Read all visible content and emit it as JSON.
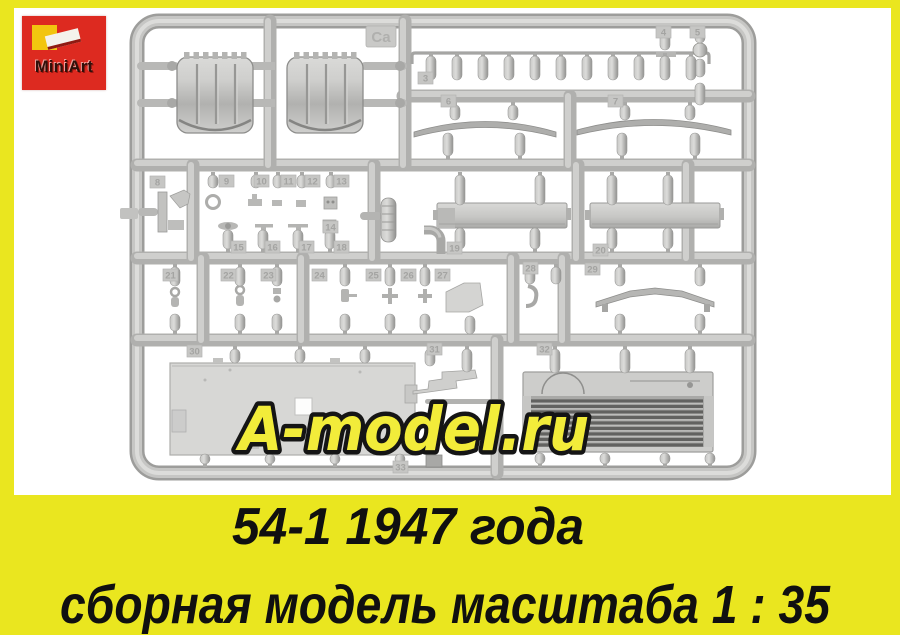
{
  "page": {
    "background_color": "#eae61f",
    "photo_background": "#ffffff"
  },
  "logo": {
    "brand": "MiniArt",
    "background_color": "#dd2a20",
    "square_color": "#f2c50f",
    "text_color": "#30100a"
  },
  "sprue": {
    "plastic_color": "#c6c6c4",
    "gate_tag": "Ca",
    "part_tags": [
      {
        "label": "3",
        "x": 418,
        "y": 72
      },
      {
        "label": "4",
        "x": 656,
        "y": 26
      },
      {
        "label": "5",
        "x": 690,
        "y": 26
      },
      {
        "label": "6",
        "x": 441,
        "y": 95
      },
      {
        "label": "7",
        "x": 608,
        "y": 95
      },
      {
        "label": "8",
        "x": 150,
        "y": 176
      },
      {
        "label": "9",
        "x": 219,
        "y": 175
      },
      {
        "label": "10",
        "x": 254,
        "y": 175
      },
      {
        "label": "11",
        "x": 281,
        "y": 175
      },
      {
        "label": "12",
        "x": 305,
        "y": 175
      },
      {
        "label": "13",
        "x": 334,
        "y": 175
      },
      {
        "label": "14",
        "x": 323,
        "y": 221
      },
      {
        "label": "15",
        "x": 231,
        "y": 241
      },
      {
        "label": "16",
        "x": 265,
        "y": 241
      },
      {
        "label": "17",
        "x": 299,
        "y": 241
      },
      {
        "label": "18",
        "x": 334,
        "y": 241
      },
      {
        "label": "19",
        "x": 447,
        "y": 242
      },
      {
        "label": "20",
        "x": 593,
        "y": 244
      },
      {
        "label": "21",
        "x": 163,
        "y": 269
      },
      {
        "label": "22",
        "x": 221,
        "y": 269
      },
      {
        "label": "23",
        "x": 261,
        "y": 269
      },
      {
        "label": "24",
        "x": 312,
        "y": 269
      },
      {
        "label": "25",
        "x": 366,
        "y": 269
      },
      {
        "label": "26",
        "x": 401,
        "y": 269
      },
      {
        "label": "27",
        "x": 435,
        "y": 269
      },
      {
        "label": "28",
        "x": 523,
        "y": 262
      },
      {
        "label": "29",
        "x": 585,
        "y": 263
      },
      {
        "label": "30",
        "x": 187,
        "y": 345
      },
      {
        "label": "31",
        "x": 427,
        "y": 343
      },
      {
        "label": "32",
        "x": 537,
        "y": 343
      },
      {
        "label": "33",
        "x": 393,
        "y": 461
      }
    ]
  },
  "watermark": {
    "text": "A-model.ru",
    "fill_color": "#f2ec3a",
    "outline_color": "#151515"
  },
  "caption": {
    "line1": "54-1 1947 года",
    "line2": "сборная модель масштаба 1 : 35",
    "text_color": "#101010",
    "background_color": "#eae61f"
  }
}
